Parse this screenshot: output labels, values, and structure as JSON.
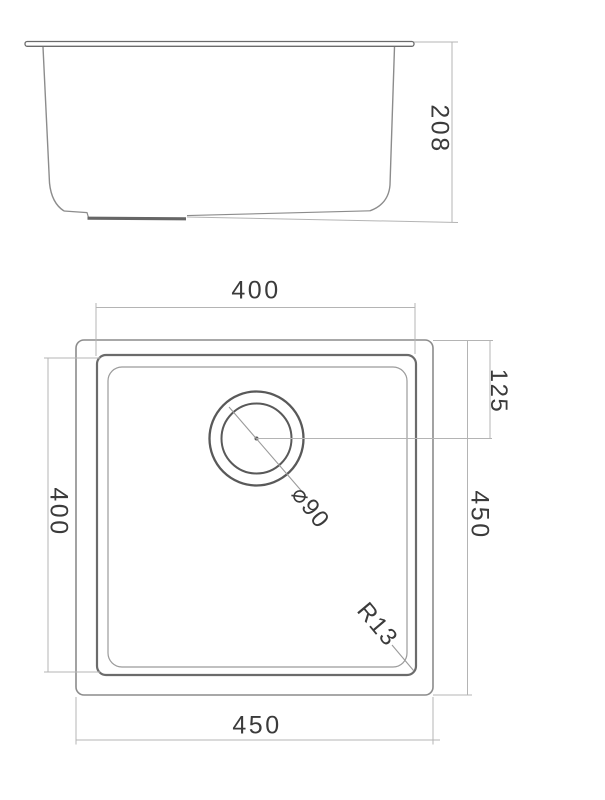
{
  "drawing_title": "undermount sink technical drawing",
  "colors": {
    "object_line": "#8c8c8c",
    "object_line_dark": "#6b6b6b",
    "dimension_line": "#b4b4b4",
    "text": "#3b3b3b",
    "background": "#ffffff"
  },
  "side_view": {
    "height_label": "208"
  },
  "plan_view": {
    "inner_width_label": "400",
    "inner_height_label": "400",
    "outer_height_label": "450",
    "outer_width_label": "450",
    "drain_offset_label": "125",
    "drain_diameter_label": "⌀90",
    "corner_radius_label": "R13"
  }
}
